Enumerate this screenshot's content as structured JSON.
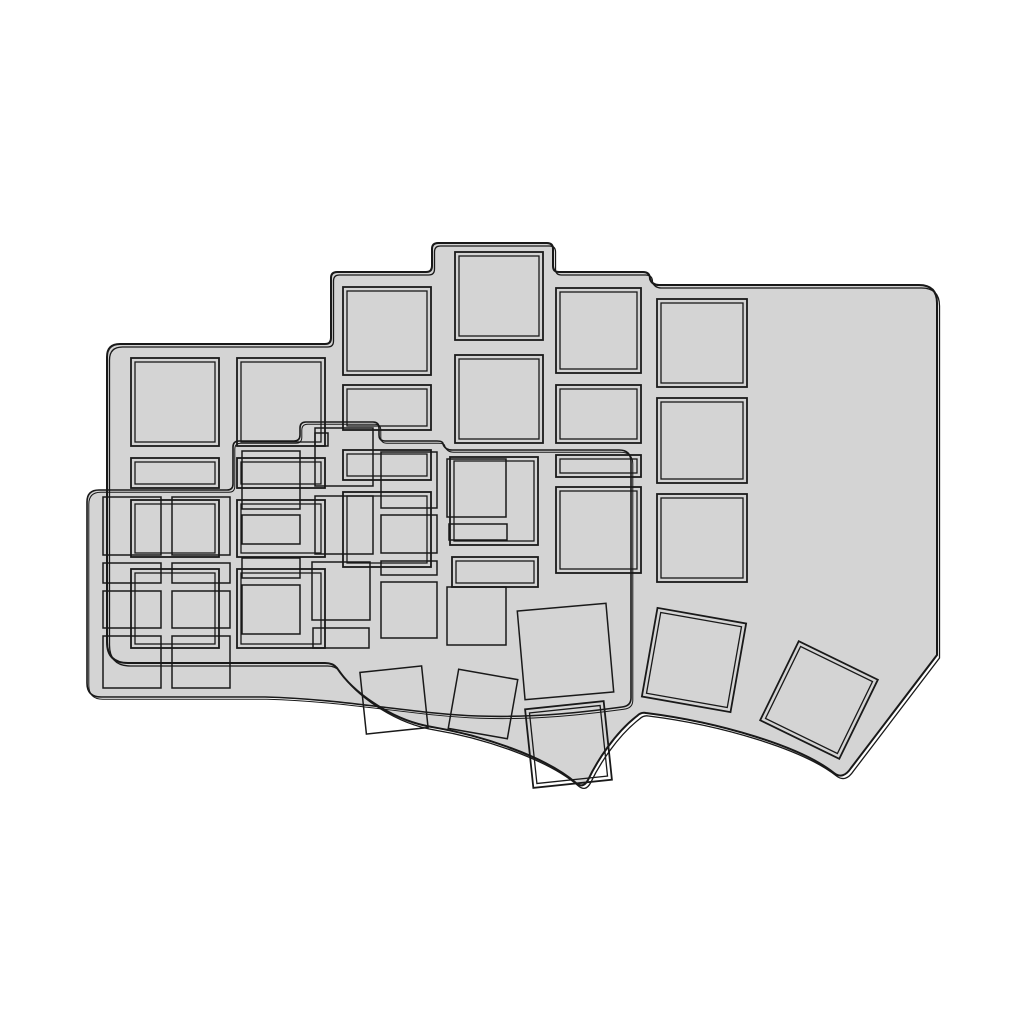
{
  "canvas": {
    "width": 1024,
    "height": 1024,
    "background": "#ffffff"
  },
  "palette": {
    "plate_fill": "#d4d4d4",
    "line": "#191919",
    "background": "#ffffff"
  },
  "scene": {
    "kind": "cad-top-view-render",
    "subject": "two overlapping ergonomic split-keyboard switch plates with square switch cutouts and rotated thumb-key cutouts",
    "text_content": ""
  },
  "plates": [
    {
      "id": "plate-large",
      "fill": "#d4d4d4",
      "outline": {
        "path": "M 107,357 Q 107,344 120,344 L 325,344 Q 331,344 331,338 L 331,278 Q 331,272 337,272 L 426,272 Q 432,272 432,266 L 432,249 Q 432,243 438,243 L 547,243 Q 553,243 553,249 L 553,266 Q 553,272 559,272 L 643,272 Q 650,272 650,279 Q 652,285 659,285 L 919,285 Q 937,285 937,303 L 937,655 L 851,768 Q 843,780 834,773 C 800,746 718,722 646,713 Q 641,712 637,716 C 615,733 597,761 588,780 Q 583,789 576,783 C 545,756 480,735 432,727 C 390,720 352,691 337,668 Q 333,663 325,663 L 128,663 Q 107,663 107,642 Z",
        "stroke_width": 2,
        "dup_offset": [
          2.5,
          3
        ],
        "dup_stroke_width": 1.3
      },
      "cutout_style": {
        "mode": "double",
        "inset": 4,
        "outer_stroke_width": 1.8,
        "inner_stroke_width": 1.3
      },
      "cutouts": [
        [
          131,
          358,
          88,
          88
        ],
        [
          131,
          458,
          88,
          30
        ],
        [
          131,
          500,
          88,
          57
        ],
        [
          131,
          569,
          88,
          79
        ],
        [
          237,
          358,
          88,
          88
        ],
        [
          237,
          458,
          88,
          30
        ],
        [
          237,
          500,
          88,
          57
        ],
        [
          237,
          569,
          88,
          79
        ],
        [
          343,
          287,
          88,
          88
        ],
        [
          343,
          385,
          88,
          45
        ],
        [
          343,
          450,
          88,
          30
        ],
        [
          343,
          492,
          88,
          75
        ],
        [
          455,
          252,
          88,
          88
        ],
        [
          455,
          355,
          88,
          88
        ],
        [
          450,
          457,
          88,
          88
        ],
        [
          452,
          557,
          86,
          30
        ],
        [
          556,
          288,
          85,
          85
        ],
        [
          556,
          385,
          85,
          58
        ],
        [
          556,
          455,
          85,
          22
        ],
        [
          556,
          487,
          85,
          86
        ],
        [
          657,
          299,
          90,
          88
        ],
        [
          657,
          398,
          90,
          85
        ],
        [
          657,
          494,
          90,
          88
        ],
        [
          529,
          705,
          79,
          79,
          -6
        ],
        [
          649,
          615,
          90,
          90,
          10
        ],
        [
          775,
          656,
          88,
          88,
          26
        ]
      ]
    },
    {
      "id": "plate-small",
      "fill": "#d4d4d4",
      "outline": {
        "path": "M 87,502 Q 87,490 99,490 L 227,490 Q 233,490 233,484 L 233,447 Q 233,441 239,441 L 294,441 Q 300,441 300,435 L 300,428 Q 300,422 306,422 L 373,422 Q 379,422 379,428 L 379,435 Q 379,441 385,441 L 437,441 Q 443,441 443,444 Q 445,450 452,450 L 619,450 Q 631,450 631,462 L 631,698 Q 631,706 622,707 C 585,712 535,718 478,716 C 415,714 345,699 265,697 L 101,697 Q 87,697 87,683 Z",
        "stroke_width": 1.6,
        "dup_offset": [
          1.8,
          2.2
        ],
        "dup_stroke_width": 1.0
      },
      "cutout_style": {
        "mode": "single",
        "outer_stroke_width": 1.5
      },
      "cutouts": [
        [
          103,
          497,
          58,
          58
        ],
        [
          103,
          563,
          58,
          20
        ],
        [
          103,
          591,
          58,
          37
        ],
        [
          103,
          636,
          58,
          52
        ],
        [
          172,
          497,
          58,
          58
        ],
        [
          172,
          563,
          58,
          20
        ],
        [
          172,
          591,
          58,
          37
        ],
        [
          172,
          636,
          58,
          52
        ],
        [
          242,
          451,
          58,
          58
        ],
        [
          242,
          515,
          58,
          29
        ],
        [
          242,
          558,
          58,
          20
        ],
        [
          242,
          585,
          58,
          49
        ],
        [
          315,
          428,
          58,
          58
        ],
        [
          315,
          496,
          58,
          58
        ],
        [
          312,
          562,
          58,
          58
        ],
        [
          313,
          628,
          56,
          20
        ],
        [
          381,
          452,
          56,
          56
        ],
        [
          381,
          515,
          56,
          38
        ],
        [
          381,
          561,
          56,
          14
        ],
        [
          381,
          582,
          56,
          56
        ],
        [
          447,
          459,
          59,
          58
        ],
        [
          449,
          524,
          58,
          16
        ],
        [
          447,
          587,
          59,
          58
        ],
        [
          315,
          433,
          13,
          13
        ],
        [
          363,
          669,
          62,
          62,
          -6
        ],
        [
          453,
          674,
          60,
          60,
          10
        ],
        [
          521,
          607,
          89,
          89,
          -5
        ]
      ]
    }
  ]
}
